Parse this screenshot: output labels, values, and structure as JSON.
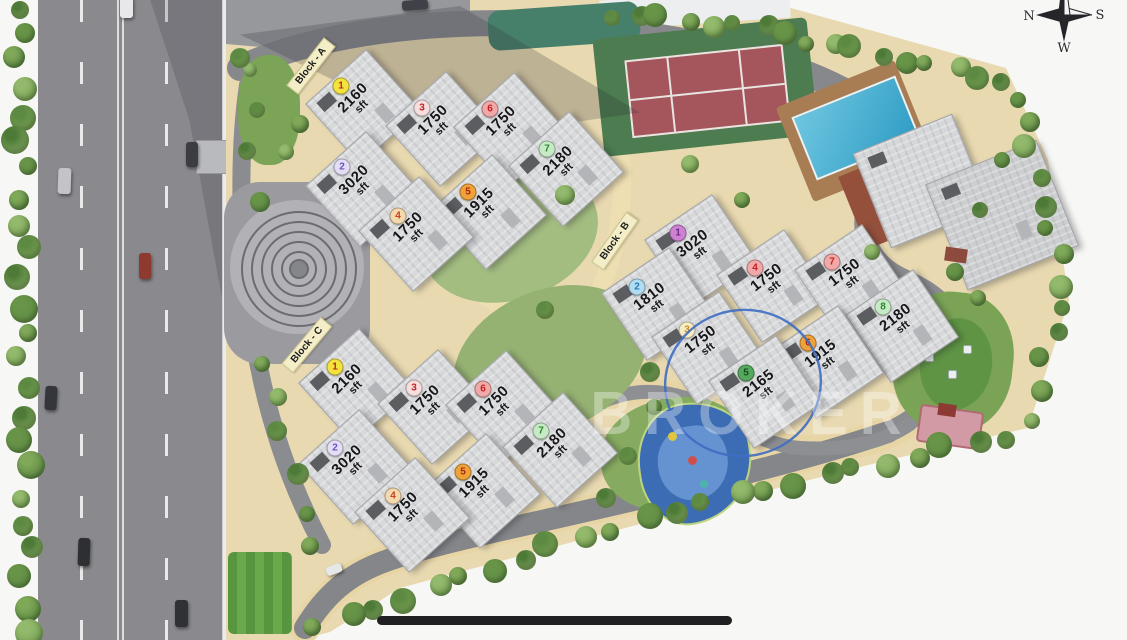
{
  "page": {
    "watermark": "BROKER",
    "background": "#f7f7f5"
  },
  "compass": {
    "n": "N",
    "s": "S",
    "w": "W"
  },
  "site_plan": {
    "blocks": [
      {
        "id": "A",
        "label": "Block - A",
        "units": [
          {
            "no": "1",
            "area": "2160",
            "unit": "sft",
            "badge_bg": "#f2e33e",
            "badge_num": "#c42222"
          },
          {
            "no": "2",
            "area": "3020",
            "unit": "sft",
            "badge_bg": "#e3def4",
            "badge_num": "#6d51c4"
          },
          {
            "no": "3",
            "area": "1750",
            "unit": "sft",
            "badge_bg": "#f6dede",
            "badge_num": "#c42222"
          },
          {
            "no": "4",
            "area": "1750",
            "unit": "sft",
            "badge_bg": "#f4d8ae",
            "badge_num": "#c8401e"
          },
          {
            "no": "5",
            "area": "1915",
            "unit": "sft",
            "badge_bg": "#efa238",
            "badge_num": "#a62616"
          },
          {
            "no": "6",
            "area": "1750",
            "unit": "sft",
            "badge_bg": "#f1a8a8",
            "badge_num": "#c42222"
          },
          {
            "no": "7",
            "area": "2180",
            "unit": "sft",
            "badge_bg": "#c6e9c6",
            "badge_num": "#2c8a2c"
          }
        ]
      },
      {
        "id": "B",
        "label": "Block - B",
        "units": [
          {
            "no": "1",
            "area": "3020",
            "unit": "sft",
            "badge_bg": "#cf82d2",
            "badge_num": "#6d2a86"
          },
          {
            "no": "2",
            "area": "1810",
            "unit": "sft",
            "badge_bg": "#b0ddf1",
            "badge_num": "#2a78b6"
          },
          {
            "no": "3",
            "area": "1750",
            "unit": "sft",
            "badge_bg": "#f5edc4",
            "badge_num": "#cf8a20"
          },
          {
            "no": "4",
            "area": "1750",
            "unit": "sft",
            "badge_bg": "#f1a8a8",
            "badge_num": "#c42222"
          },
          {
            "no": "5",
            "area": "2165",
            "unit": "sft",
            "badge_bg": "#55a85e",
            "badge_num": "#174f1f"
          },
          {
            "no": "6",
            "area": "1915",
            "unit": "sft",
            "badge_bg": "#efa238",
            "badge_num": "#a62616"
          },
          {
            "no": "7",
            "area": "1750",
            "unit": "sft",
            "badge_bg": "#f1a8a8",
            "badge_num": "#c42222"
          },
          {
            "no": "8",
            "area": "2180",
            "unit": "sft",
            "badge_bg": "#c6e9c6",
            "badge_num": "#2c8a2c"
          }
        ]
      },
      {
        "id": "C",
        "label": "Block - C",
        "units": [
          {
            "no": "1",
            "area": "2160",
            "unit": "sft",
            "badge_bg": "#f2e33e",
            "badge_num": "#c42222"
          },
          {
            "no": "2",
            "area": "3020",
            "unit": "sft",
            "badge_bg": "#e3def4",
            "badge_num": "#6d51c4"
          },
          {
            "no": "3",
            "area": "1750",
            "unit": "sft",
            "badge_bg": "#f6dede",
            "badge_num": "#c42222"
          },
          {
            "no": "4",
            "area": "1750",
            "unit": "sft",
            "badge_bg": "#f4d8ae",
            "badge_num": "#c8401e"
          },
          {
            "no": "5",
            "area": "1915",
            "unit": "sft",
            "badge_bg": "#efa238",
            "badge_num": "#a62616"
          },
          {
            "no": "6",
            "area": "1750",
            "unit": "sft",
            "badge_bg": "#f1a8a8",
            "badge_num": "#c42222"
          },
          {
            "no": "7",
            "area": "2180",
            "unit": "sft",
            "badge_bg": "#c6e9c6",
            "badge_num": "#2c8a2c"
          }
        ]
      }
    ],
    "highlight": {
      "type": "hand-drawn-ellipse",
      "around_block": "B",
      "around_unit": "5",
      "color": "#3f6dc2"
    },
    "features": [
      "highway",
      "tennis-court",
      "swimming-pool",
      "clubhouse",
      "central-plaza",
      "kids-play-area",
      "garden",
      "perimeter-road"
    ]
  }
}
